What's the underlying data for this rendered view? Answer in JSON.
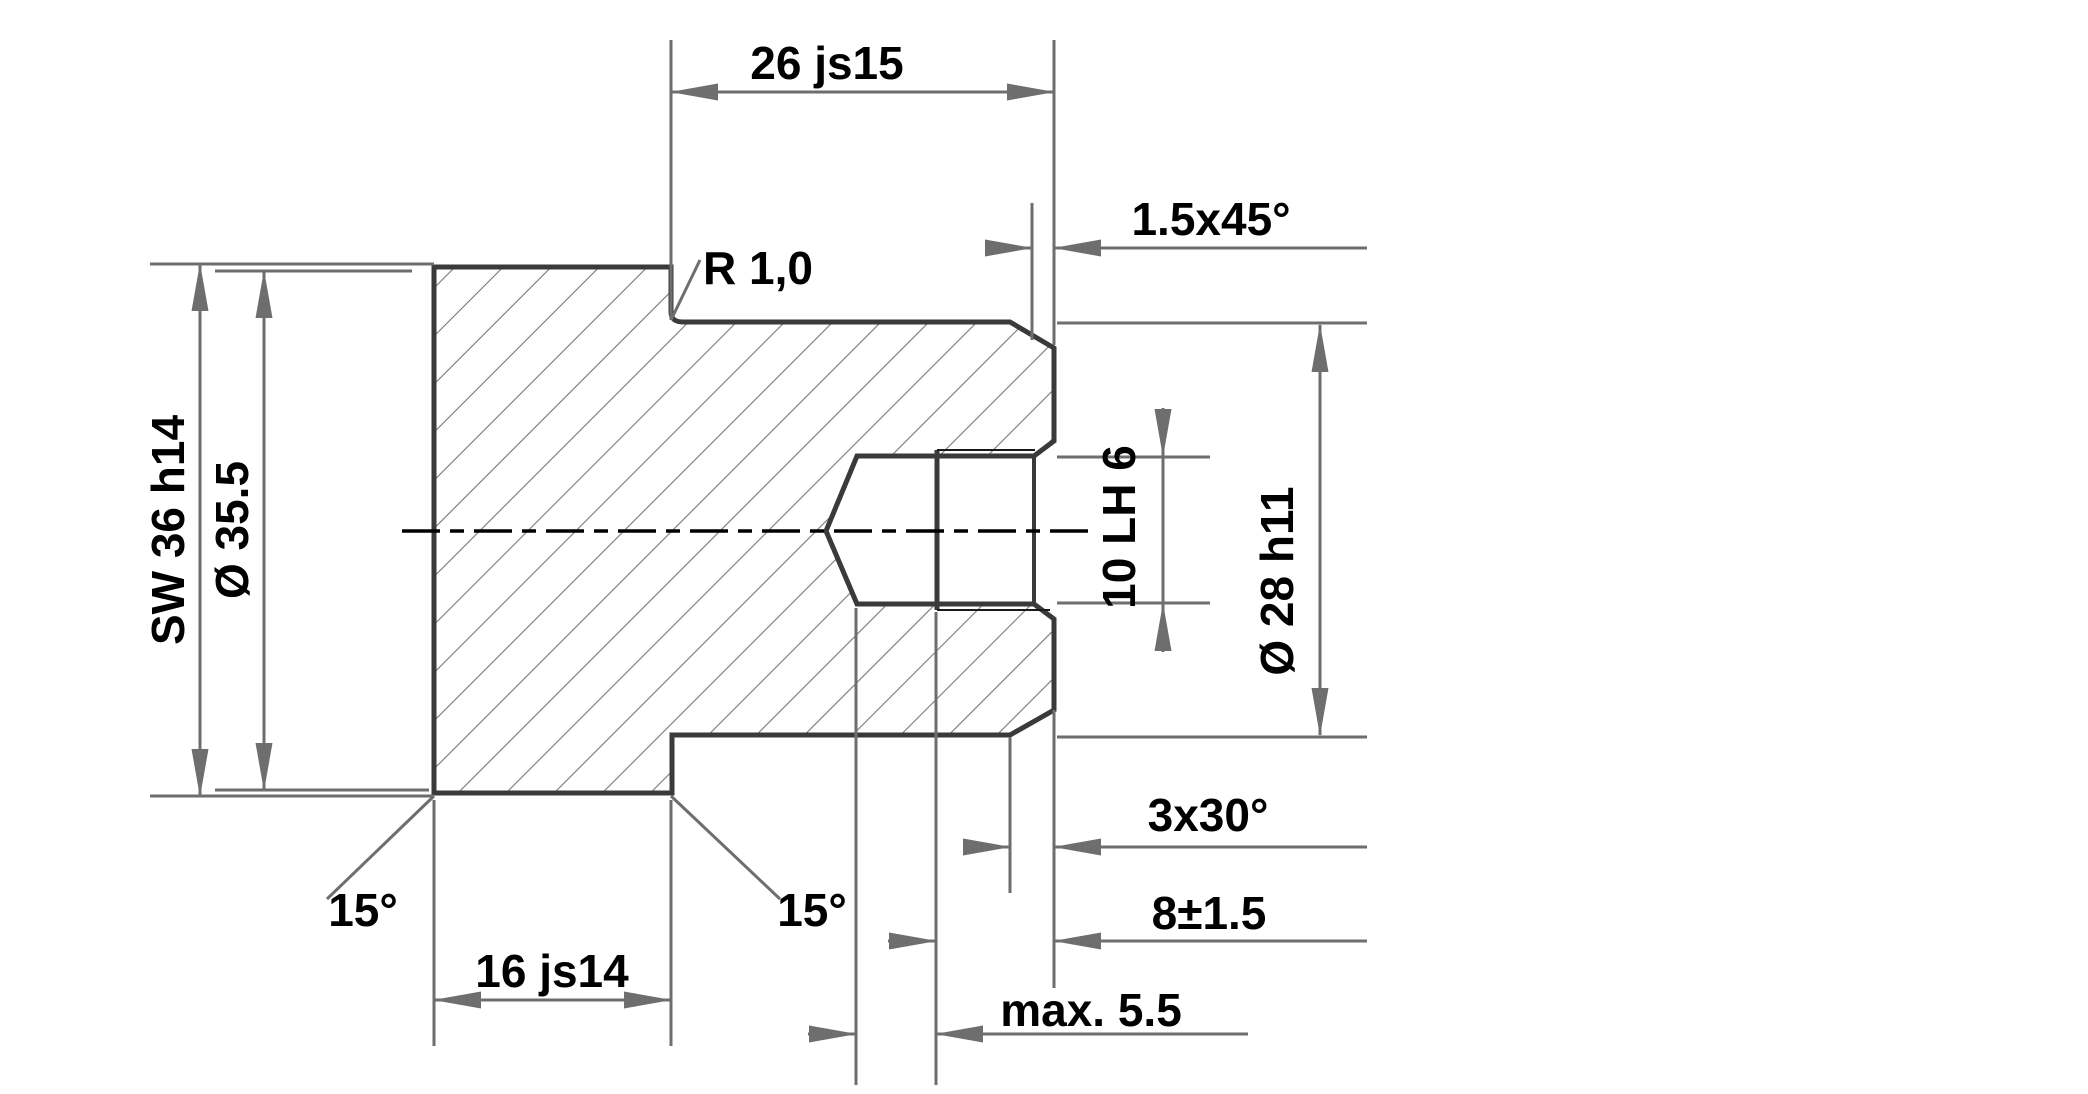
{
  "drawing": {
    "type": "technical-drawing",
    "view": "section-view-threaded-hex-plug",
    "colors": {
      "background": "#ffffff",
      "outline": "#3a3a3a",
      "dimension_lines": "#6e6e6e",
      "hatch": "#7a7a7a",
      "text": "#000000"
    },
    "labels": {
      "overall_length": "26 js15",
      "front_chamfer": "1.5x45°",
      "fillet_radius": "R 1,0",
      "hex_width_across_flats": "SW 36 h14",
      "turned_diameter": "Ø 35.5",
      "thread_size": "10 LH 6",
      "shank_diameter": "Ø 28 h11",
      "hex_chamfer_angle_left": "15°",
      "hex_chamfer_angle_right": "15°",
      "hex_length": "16 js14",
      "rear_chamfer": "3x30°",
      "thread_depth": "8±1.5",
      "drill_overrun": "max. 5.5"
    }
  }
}
